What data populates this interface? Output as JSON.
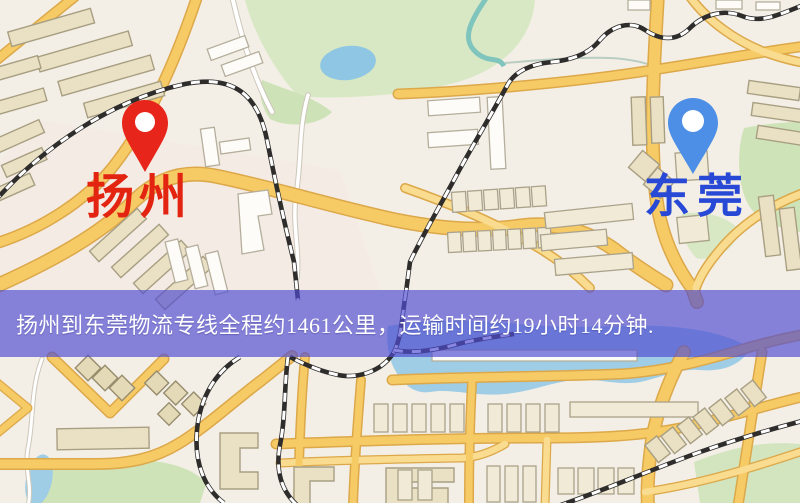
{
  "banner": {
    "text": "扬州到东莞物流专线全程约1461公里，运输时间约19小时14分钟.",
    "background_color": "#504cd2",
    "text_color": "#ffffff"
  },
  "markers": {
    "origin": {
      "label": "扬州",
      "pin_color": "#e8251a",
      "label_color": "#e32411"
    },
    "destination": {
      "label": "东莞",
      "pin_color": "#4d8fe6",
      "label_color": "#2849d5"
    }
  },
  "map_colors": {
    "background": "#f4efe6",
    "road_yellow": "#f6cb66",
    "road_casing": "#dca84a",
    "park_green": "#d8e8c4",
    "water_blue": "#9fcde6",
    "railway": "#2e2d2c",
    "building_tan": "#eae1c4"
  }
}
